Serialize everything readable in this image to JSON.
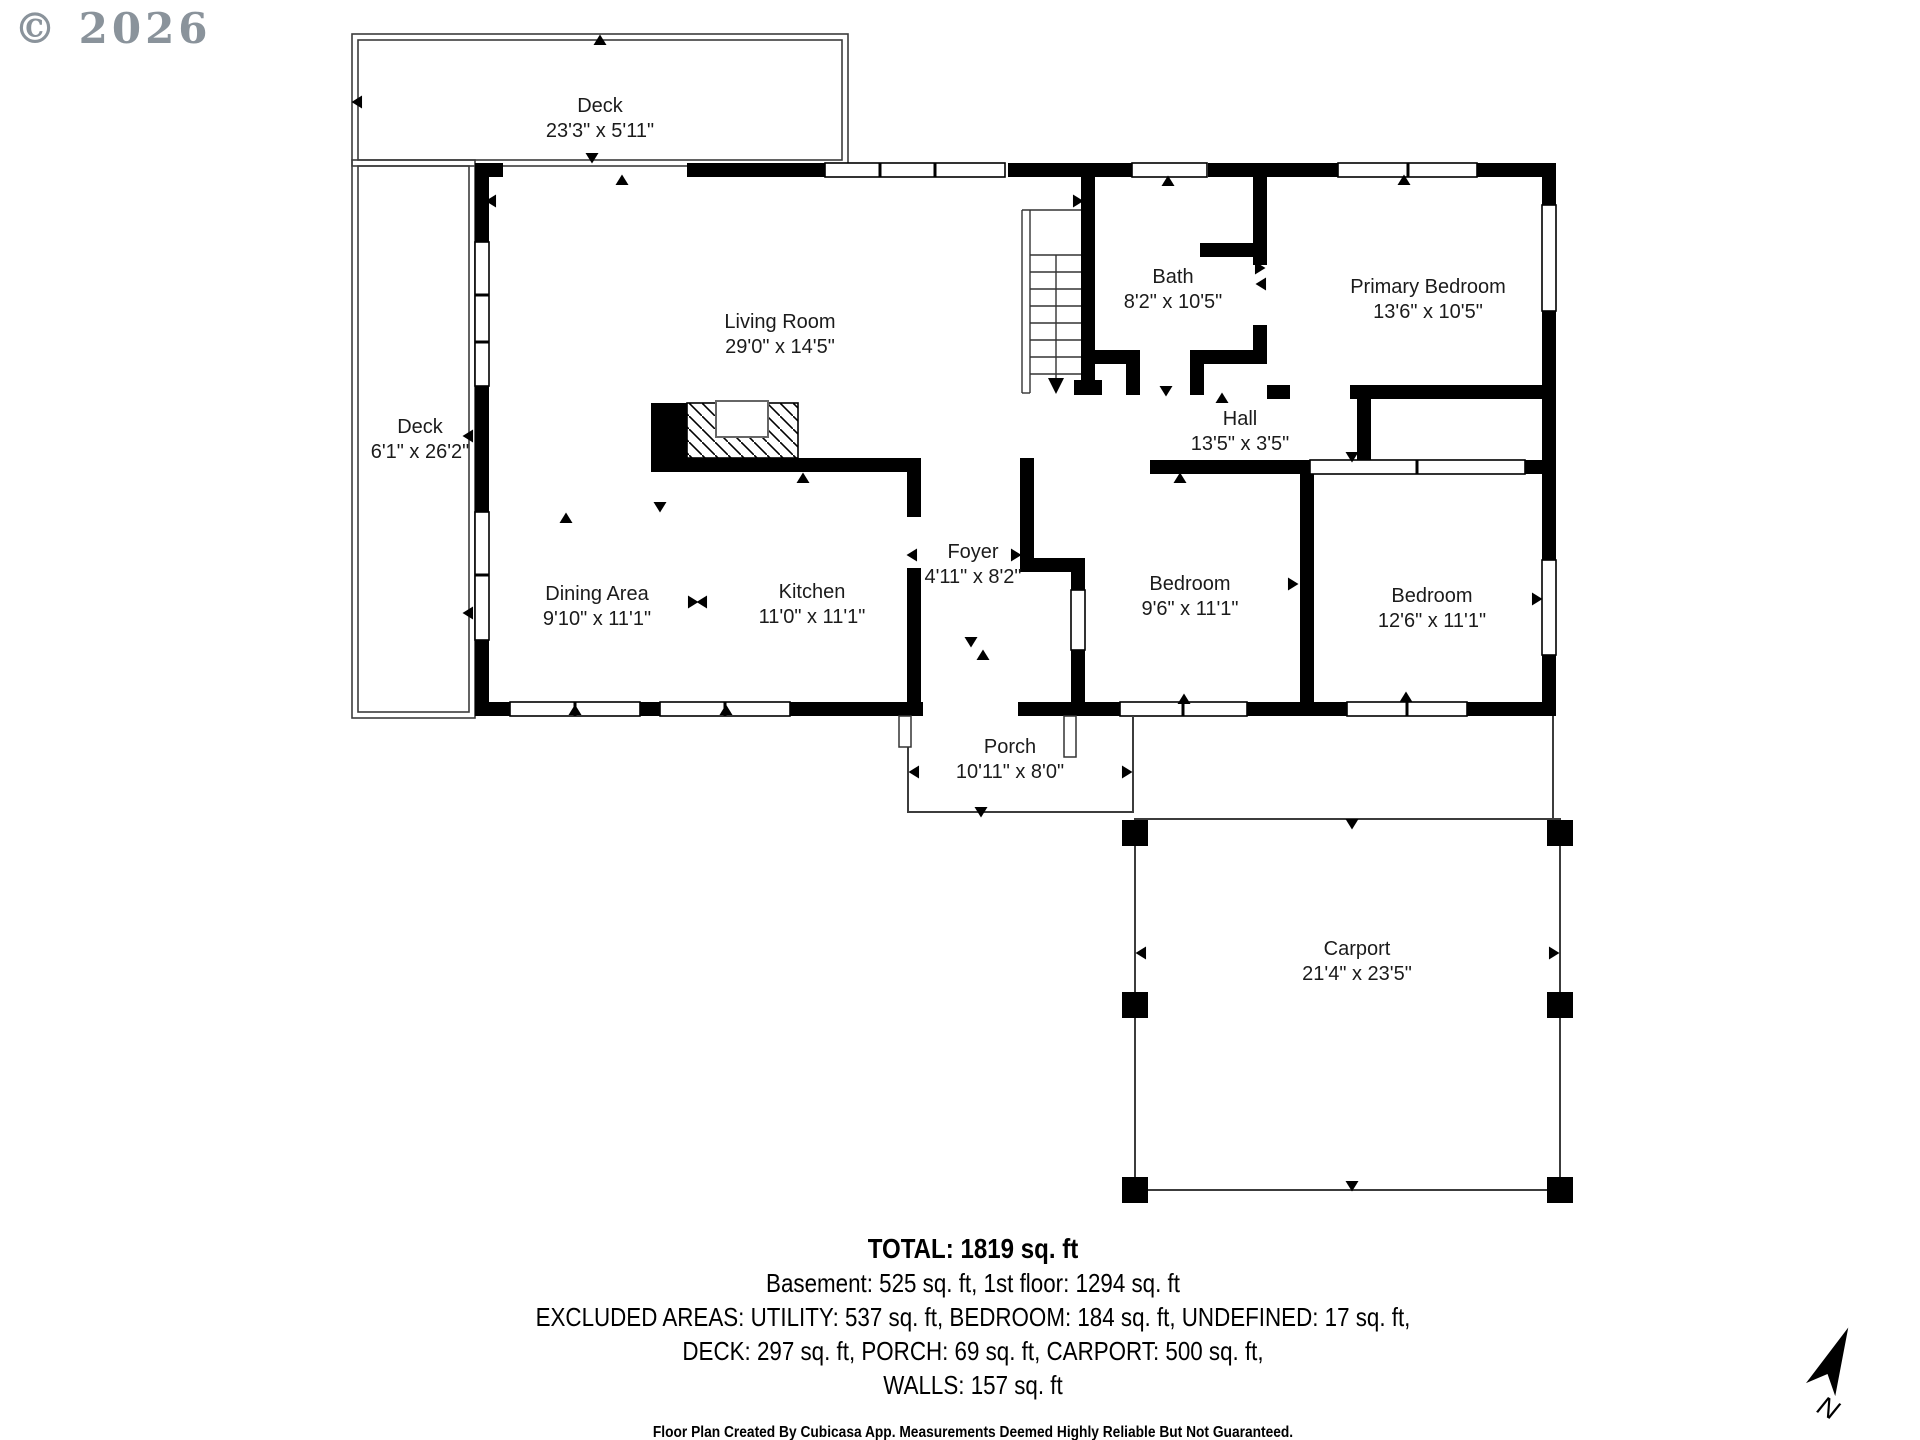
{
  "watermark": "© 2026",
  "north_label": "N",
  "rooms": [
    {
      "id": "deck-top",
      "label": "Deck",
      "dims": "23'3\" x 5'11\"",
      "x": 600,
      "y": 112
    },
    {
      "id": "deck-left",
      "label": "Deck",
      "dims": "6'1\" x 26'2\"",
      "x": 420,
      "y": 433
    },
    {
      "id": "living-room",
      "label": "Living Room",
      "dims": "29'0\" x 14'5\"",
      "x": 780,
      "y": 328
    },
    {
      "id": "bath",
      "label": "Bath",
      "dims": "8'2\" x 10'5\"",
      "x": 1173,
      "y": 283
    },
    {
      "id": "primary-bedroom",
      "label": "Primary Bedroom",
      "dims": "13'6\" x 10'5\"",
      "x": 1428,
      "y": 293
    },
    {
      "id": "hall",
      "label": "Hall",
      "dims": "13'5\" x 3'5\"",
      "x": 1240,
      "y": 425
    },
    {
      "id": "dining-area",
      "label": "Dining Area",
      "dims": "9'10\" x 11'1\"",
      "x": 597,
      "y": 600
    },
    {
      "id": "kitchen",
      "label": "Kitchen",
      "dims": "11'0\" x 11'1\"",
      "x": 812,
      "y": 598
    },
    {
      "id": "foyer",
      "label": "Foyer",
      "dims": "4'11\" x 8'2\"",
      "x": 973,
      "y": 558
    },
    {
      "id": "bedroom-1",
      "label": "Bedroom",
      "dims": "9'6\" x 11'1\"",
      "x": 1190,
      "y": 590
    },
    {
      "id": "bedroom-2",
      "label": "Bedroom",
      "dims": "12'6\" x 11'1\"",
      "x": 1432,
      "y": 602
    },
    {
      "id": "porch",
      "label": "Porch",
      "dims": "10'11\" x 8'0\"",
      "x": 1010,
      "y": 753
    },
    {
      "id": "carport",
      "label": "Carport",
      "dims": "21'4\" x 23'5\"",
      "x": 1357,
      "y": 955
    }
  ],
  "summary": {
    "total": "TOTAL: 1819 sq. ft",
    "line1": "Basement: 525 sq. ft, 1st floor: 1294 sq. ft",
    "line2": "EXCLUDED AREAS: UTILITY: 537 sq. ft, BEDROOM: 184 sq. ft, UNDEFINED: 17 sq. ft,",
    "line3": "DECK: 297 sq. ft, PORCH: 69 sq. ft, CARPORT: 500 sq. ft,",
    "line4": "WALLS: 157 sq. ft"
  },
  "footer": "Floor Plan Created By Cubicasa App. Measurements Deemed Highly Reliable But Not Guaranteed."
}
